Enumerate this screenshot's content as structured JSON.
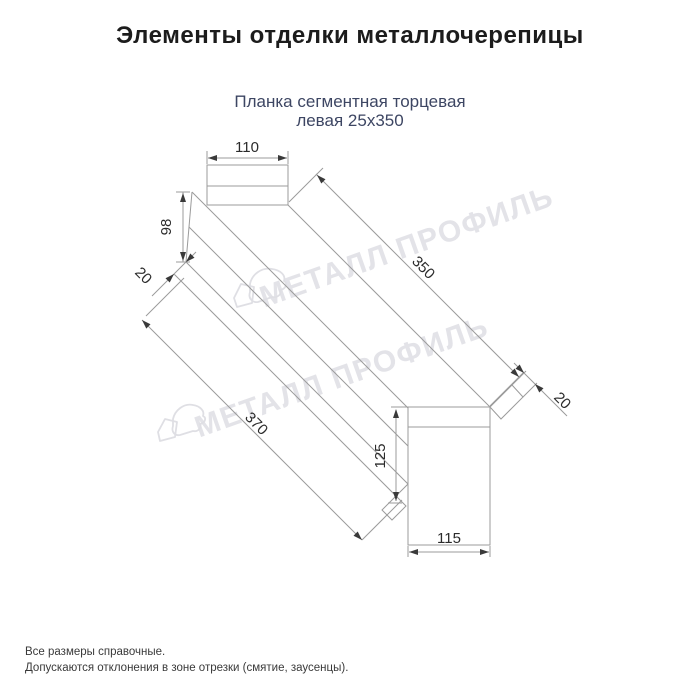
{
  "header": {
    "title": "Элементы отделки металлочерепицы"
  },
  "product": {
    "name_line1": "Планка сегментная торцевая",
    "name_line2": "левая 25х350"
  },
  "drawing": {
    "type": "technical-dimension-drawing",
    "dimensions": {
      "top_flange_width": "110",
      "left_end_height": "98",
      "left_fold": "20",
      "top_length": "350",
      "bottom_length": "370",
      "right_fold": "20",
      "right_end_height": "125",
      "right_end_width": "115"
    }
  },
  "watermark": {
    "text": "МЕТАЛЛ ПРОФИЛЬ"
  },
  "footnotes": {
    "line1": "Все размеры справочные.",
    "line2": "Допускаются отклонения в зоне отрезки (смятие, заусенцы)."
  },
  "colors": {
    "title": "#1c1c1c",
    "subtitle": "#3d4663",
    "drawing_lines": "#9b9b9b",
    "dimension_text": "#2b2b2b",
    "watermark": "#e3e3e8",
    "background": "#ffffff"
  }
}
